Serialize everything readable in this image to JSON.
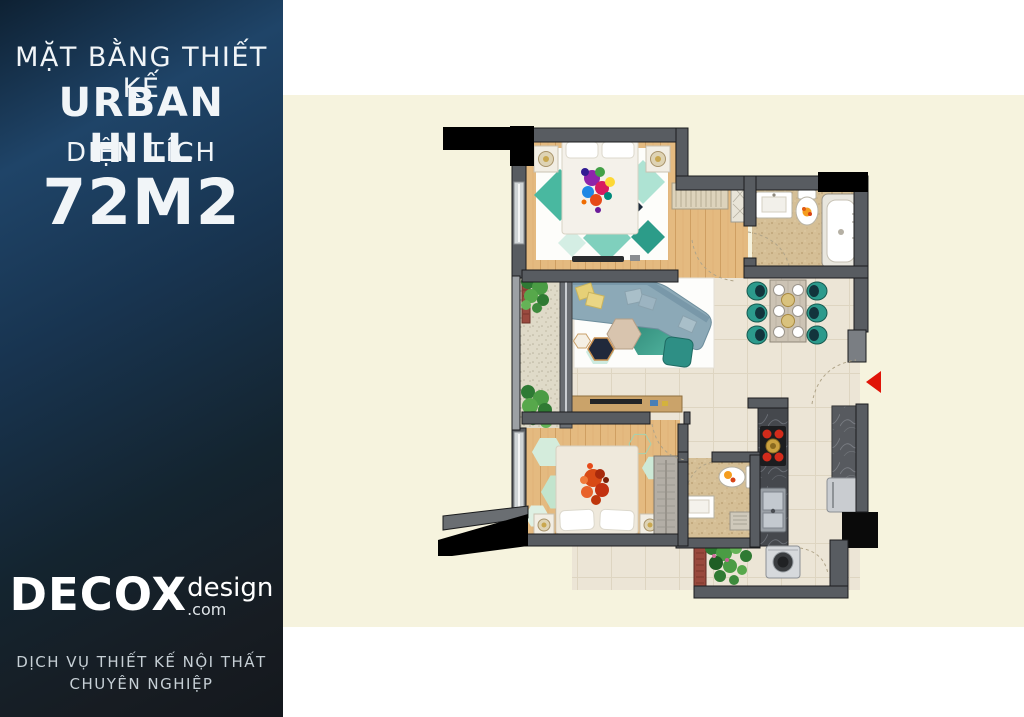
{
  "sidebar": {
    "title": "MẶT BẰNG THIẾT KẾ",
    "project_name": "URBAN HILL",
    "area_label": "DIỆN TÍCH",
    "area_value": "72M2",
    "logo": {
      "brand": "DECOX",
      "suffix": "design",
      "domain": ".com"
    },
    "footer_line1": "DỊCH VỤ THIẾT KẾ NỘI THẤT",
    "footer_line2": "CHUYÊN NGHIỆP"
  },
  "floor_plan": {
    "type": "apartment-top-view-render",
    "entrance_marker": "red-arrow-left",
    "colors": {
      "canvas_band": "#f6f3de",
      "sidebar_top": "#1f4468",
      "sidebar_bottom": "#14181d",
      "wall_gray": "#585c61",
      "wood_floor": "#e4ba80",
      "tile_floor": "#ece5d6",
      "bath_tile": "#d5bf96",
      "accent_teal": "#2c9a8c",
      "arrow_red": "#e01408"
    }
  }
}
